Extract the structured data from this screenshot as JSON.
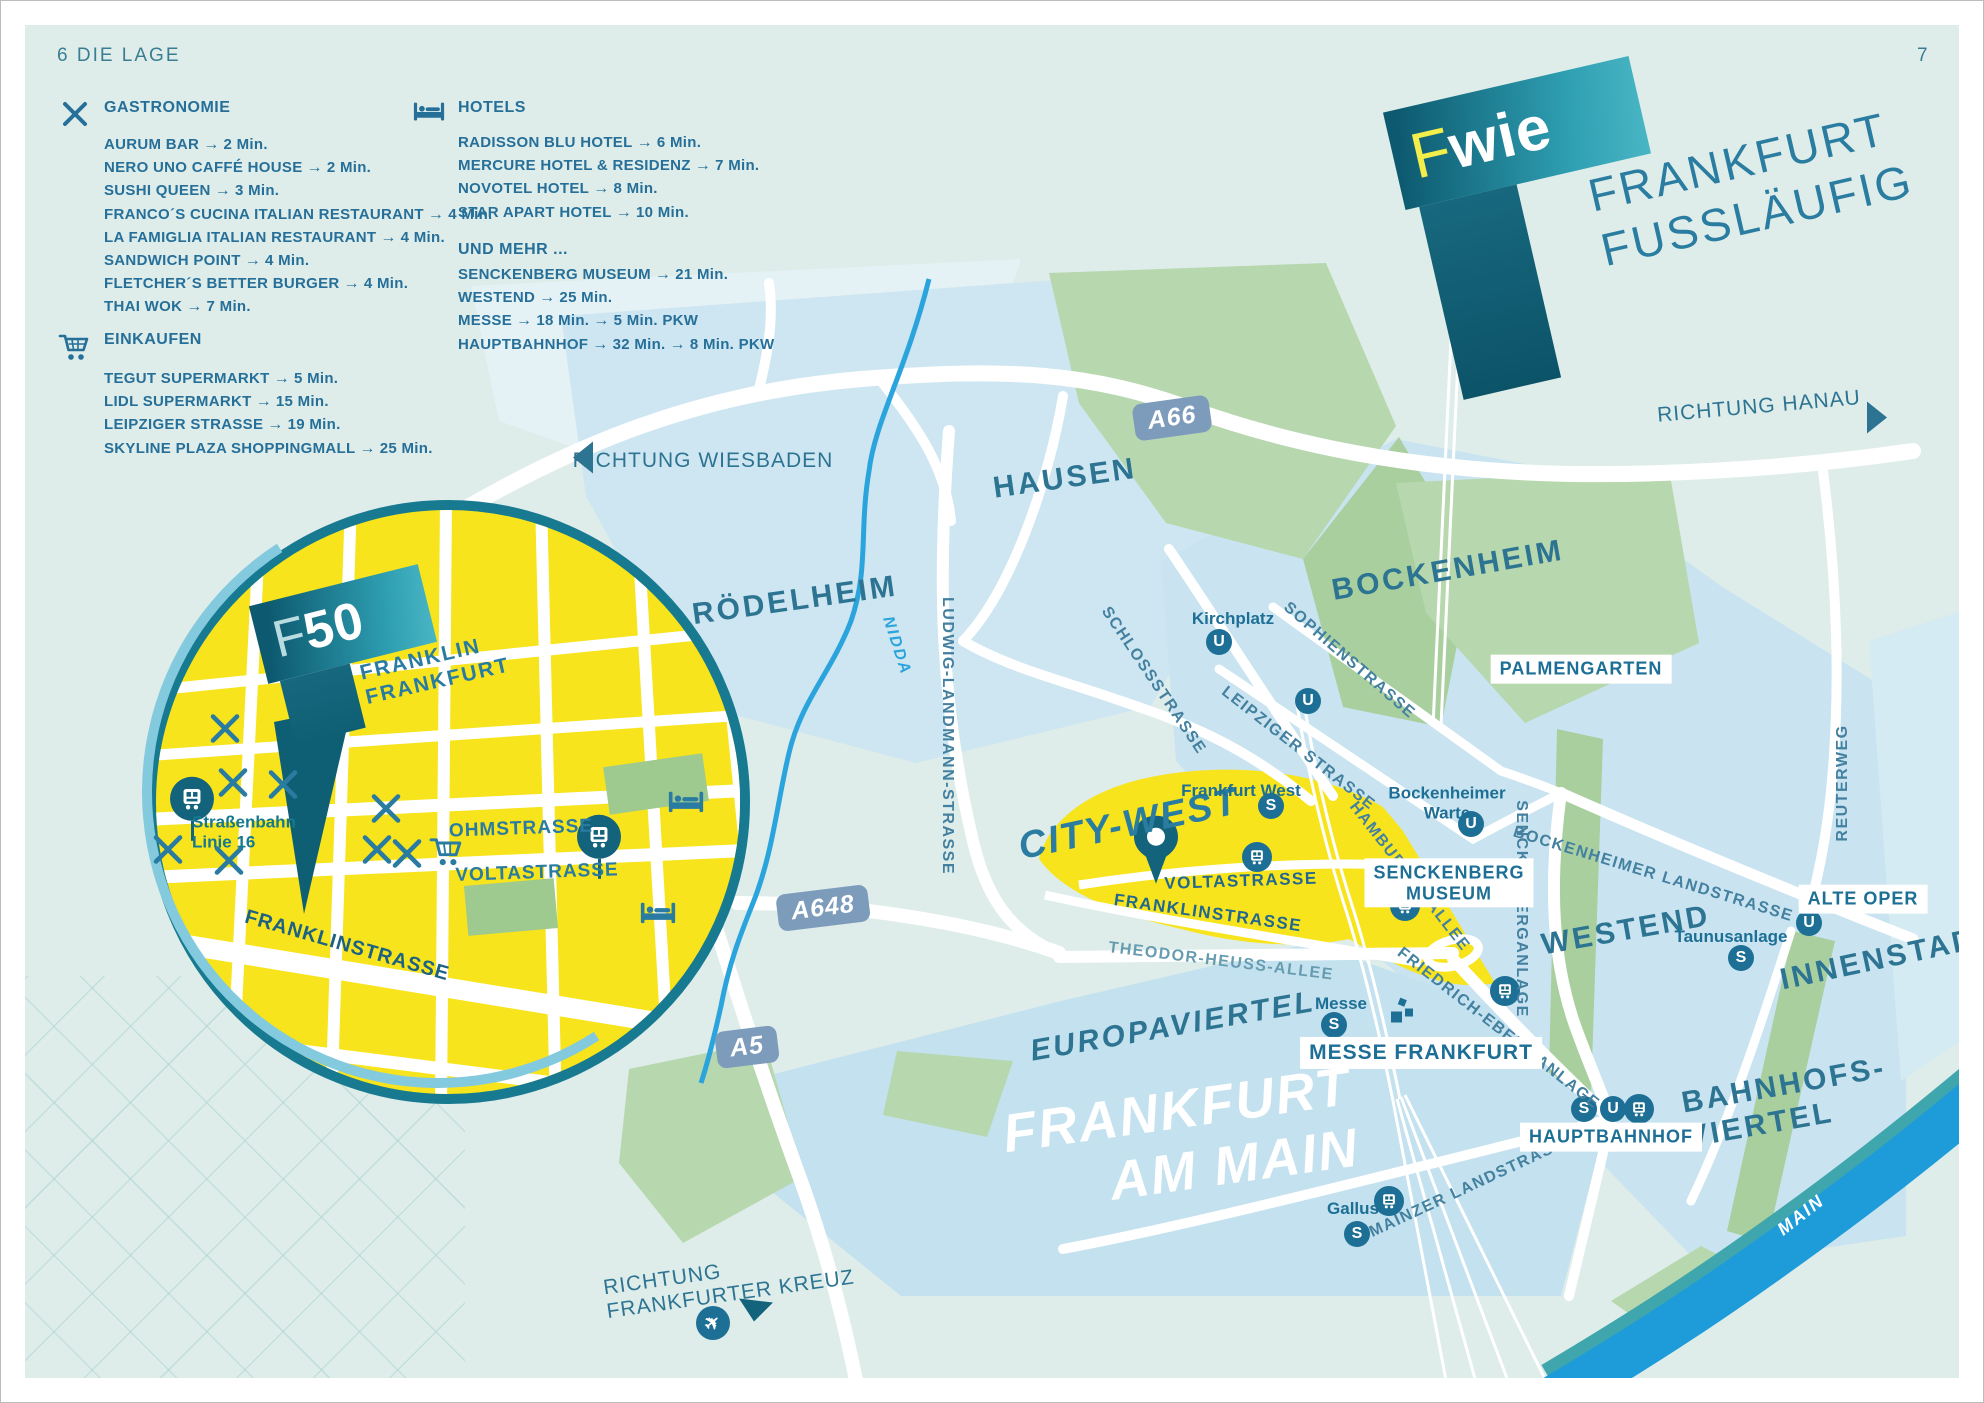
{
  "page": {
    "left_label": "6  DIE LAGE",
    "right_label": "7"
  },
  "colors": {
    "accent_teal": "#1d6f95",
    "district_teal": "#2d7492",
    "yellow": "#f7e41c",
    "light_blue": "#c9e4f0",
    "green": "#b7d7ae",
    "river_blue": "#1e9bd9",
    "badge_blue": "#7d9cbc",
    "logo_yellow": "#f3ee49",
    "rim_teal": "#177a90"
  },
  "legend": {
    "gastronomie": {
      "title": "GASTRONOMIE",
      "icon": "fork-knife-icon",
      "items": [
        {
          "label": "AURUM BAR",
          "times": [
            "2 Min."
          ]
        },
        {
          "label": "NERO UNO CAFFÉ HOUSE",
          "times": [
            "2 Min."
          ]
        },
        {
          "label": "SUSHI QUEEN",
          "times": [
            "3 Min."
          ]
        },
        {
          "label": "FRANCO´S CUCINA ITALIAN RESTAURANT",
          "times": [
            "4 Min."
          ]
        },
        {
          "label": "LA FAMIGLIA ITALIAN RESTAURANT",
          "times": [
            "4 Min."
          ]
        },
        {
          "label": "SANDWICH POINT",
          "times": [
            "4 Min."
          ]
        },
        {
          "label": "FLETCHER´S BETTER BURGER",
          "times": [
            "4 Min."
          ]
        },
        {
          "label": "THAI WOK",
          "times": [
            "7 Min."
          ]
        }
      ]
    },
    "einkaufen": {
      "title": "EINKAUFEN",
      "icon": "shopping-cart-icon",
      "items": [
        {
          "label": "TEGUT SUPERMARKT",
          "times": [
            "5 Min."
          ]
        },
        {
          "label": "LIDL SUPERMARKT",
          "times": [
            "15 Min."
          ]
        },
        {
          "label": "LEIPZIGER STRASSE",
          "times": [
            "19 Min."
          ]
        },
        {
          "label": "SKYLINE PLAZA SHOPPINGMALL",
          "times": [
            "25 Min."
          ]
        }
      ]
    },
    "hotels": {
      "title": "HOTELS",
      "icon": "hotel-bed-icon",
      "items": [
        {
          "label": "RADISSON BLU HOTEL",
          "times": [
            "6 Min."
          ]
        },
        {
          "label": "MERCURE HOTEL & RESIDENZ",
          "times": [
            "7 Min."
          ]
        },
        {
          "label": "NOVOTEL HOTEL",
          "times": [
            "8 Min."
          ]
        },
        {
          "label": "STAR APART HOTEL",
          "times": [
            "10 Min."
          ]
        }
      ]
    },
    "und_mehr": {
      "title": "UND MEHR ...",
      "items": [
        {
          "label": "SENCKENBERG MUSEUM",
          "times": [
            "21 Min."
          ]
        },
        {
          "label": "WESTEND",
          "times": [
            "25 Min."
          ]
        },
        {
          "label": "MESSE",
          "times": [
            "18 Min.",
            "5 Min. PKW"
          ]
        },
        {
          "label": "HAUPTBAHNHOF",
          "times": [
            "32 Min.",
            "8 Min. PKW"
          ]
        }
      ]
    },
    "arrow": "→"
  },
  "logo": {
    "f": "F",
    "wie": "wie",
    "line1": "FRANKFURT",
    "line2": "FUSSLÄUFIG"
  },
  "inset_logo": {
    "f": "F",
    "n50": "50"
  },
  "map": {
    "labels": [
      {
        "t": "RÖDELHEIM",
        "x": 794,
        "y": 600,
        "r": -8,
        "c": "district",
        "n": "district-roedelheim"
      },
      {
        "t": "HAUSEN",
        "x": 1064,
        "y": 478,
        "r": -8,
        "c": "district",
        "n": "district-hausen"
      },
      {
        "t": "BOCKENHEIM",
        "x": 1447,
        "y": 570,
        "r": -10,
        "c": "district",
        "n": "district-bockenheim"
      },
      {
        "t": "WESTEND",
        "x": 1625,
        "y": 930,
        "r": -10,
        "c": "district",
        "n": "district-westend"
      },
      {
        "t": "INNENSTADT",
        "x": 1888,
        "y": 957,
        "r": -12,
        "c": "district",
        "n": "district-innenstadt"
      },
      {
        "lines": [
          "BAHNHOFS-",
          "VIERTEL"
        ],
        "x": 1786,
        "y": 1102,
        "r": -10,
        "c": "district",
        "n": "district-bahnhofsviertel"
      },
      {
        "t": "EUROPAVIERTEL",
        "x": 1172,
        "y": 1026,
        "r": -10,
        "c": "district italic",
        "n": "district-europaviertel"
      },
      {
        "t": "CITY-WEST",
        "x": 1128,
        "y": 824,
        "r": -12,
        "c": "citywest",
        "n": "district-city-west"
      },
      {
        "lines": [
          "FRANKFURT",
          "AM MAIN"
        ],
        "x": 1180,
        "y": 1140,
        "r": -8,
        "c": "bigcity",
        "n": "label-frankfurt-am-main"
      },
      {
        "t": "SCHLOSSSTRASSE",
        "x": 1152,
        "y": 680,
        "r": 56,
        "c": "street",
        "n": "street-schlossstrasse"
      },
      {
        "t": "SOPHIENSTRASSE",
        "x": 1348,
        "y": 660,
        "r": 41,
        "c": "street",
        "n": "street-sophienstrasse"
      },
      {
        "t": "LEIPZIGER STRASSE",
        "x": 1297,
        "y": 748,
        "r": 38,
        "c": "street",
        "n": "street-leipziger-strasse"
      },
      {
        "t": "LUDWIG-LANDMANN-STRASSE",
        "x": 946,
        "y": 735,
        "r": 90,
        "c": "street",
        "n": "street-ludwig-landmann-strasse"
      },
      {
        "t": "HAMBURGER ALLEE",
        "x": 1408,
        "y": 876,
        "r": 52,
        "c": "street",
        "n": "street-hamburger-allee"
      },
      {
        "t": "SENCKENBERGANLAGE",
        "x": 1520,
        "y": 908,
        "r": 90,
        "c": "street",
        "n": "street-senckenberganlage"
      },
      {
        "t": "BOCKENHEIMER LANDSTRASSE",
        "x": 1652,
        "y": 874,
        "r": 17,
        "c": "street",
        "n": "street-bockenheimer-landstrasse"
      },
      {
        "t": "FRIEDRICH-EBERT-ANLAGE",
        "x": 1497,
        "y": 1028,
        "r": 38,
        "c": "street",
        "n": "street-friedrich-ebert-anlage"
      },
      {
        "t": "THEODOR-HEUSS-ALLEE",
        "x": 1220,
        "y": 961,
        "r": 7,
        "c": "street light",
        "n": "street-theodor-heuss-allee"
      },
      {
        "t": "MAINZER LANDSTRASSE",
        "x": 1472,
        "y": 1185,
        "r": -25,
        "c": "street",
        "n": "street-mainzer-landstrasse"
      },
      {
        "t": "REUTERWEG",
        "x": 1842,
        "y": 782,
        "r": -90,
        "c": "street",
        "n": "street-reuterweg"
      },
      {
        "t": "VOLTASTRASSE",
        "x": 1240,
        "y": 880,
        "r": -2,
        "c": "street strong",
        "n": "street-voltastrasse-citywest"
      },
      {
        "t": "FRANKLINSTRASSE",
        "x": 1207,
        "y": 912,
        "r": 8,
        "c": "street strong",
        "n": "street-franklinstrasse-citywest"
      },
      {
        "t": "NIDDA",
        "x": 895,
        "y": 645,
        "r": 72,
        "c": "river",
        "n": "river-nidda-label"
      },
      {
        "t": "MAIN",
        "x": 1800,
        "y": 1214,
        "r": -38,
        "c": "mainriver",
        "n": "river-main-label"
      },
      {
        "t": "Kirchplatz",
        "x": 1232,
        "y": 618,
        "r": 0,
        "c": "stn",
        "n": "station-kirchplatz"
      },
      {
        "lines": [
          "Bockenheimer",
          "Warte"
        ],
        "x": 1446,
        "y": 802,
        "r": 0,
        "c": "stn",
        "n": "station-bockenheimer-warte"
      },
      {
        "t": "Frankfurt West",
        "x": 1240,
        "y": 790,
        "r": 0,
        "c": "stn",
        "n": "station-frankfurt-west"
      },
      {
        "t": "Taunusanlage",
        "x": 1730,
        "y": 936,
        "r": 0,
        "c": "stn",
        "n": "station-taunusanlage"
      },
      {
        "t": "Messe",
        "x": 1340,
        "y": 1003,
        "r": 0,
        "c": "stn",
        "n": "station-messe"
      },
      {
        "t": "Gallus",
        "x": 1352,
        "y": 1208,
        "r": 0,
        "c": "stn",
        "n": "station-gallus"
      },
      {
        "t": "PALMENGARTEN",
        "x": 1580,
        "y": 668,
        "r": 0,
        "c": "boxlabel",
        "n": "poi-palmengarten"
      },
      {
        "lines": [
          "SENCKENBERG",
          "MUSEUM"
        ],
        "x": 1448,
        "y": 882,
        "r": 0,
        "c": "boxlabel",
        "n": "poi-senckenberg-museum"
      },
      {
        "t": "ALTE OPER",
        "x": 1862,
        "y": 898,
        "r": 0,
        "c": "boxlabel",
        "n": "poi-alte-oper"
      },
      {
        "t": "HAUPTBAHNHOF",
        "x": 1610,
        "y": 1136,
        "r": 0,
        "c": "boxlabel",
        "n": "poi-hauptbahnhof"
      },
      {
        "t": "MESSE FRANKFURT",
        "x": 1420,
        "y": 1052,
        "r": 0,
        "c": "boxlabel big",
        "n": "poi-messe-frankfurt"
      },
      {
        "t": "RICHTUNG WIESBADEN",
        "x": 702,
        "y": 460,
        "r": 0,
        "c": "direction",
        "n": "direction-wiesbaden"
      },
      {
        "t": "RICHTUNG HANAU",
        "x": 1758,
        "y": 406,
        "r": -5,
        "c": "direction",
        "n": "direction-hanau"
      },
      {
        "lines": [
          "RICHTUNG",
          "FRANKFURTER KREUZ"
        ],
        "x": 728,
        "y": 1282,
        "r": -8,
        "c": "direction left",
        "n": "direction-frankfurter-kreuz"
      },
      {
        "lines": [
          "Straßenbahn",
          "Linie 16"
        ],
        "x": 243,
        "y": 831,
        "r": 0,
        "c": "tramlabel",
        "n": "label-strassenbahn-linie-16"
      },
      {
        "t": "OHMSTRASSE",
        "x": 520,
        "y": 828,
        "r": -2,
        "c": "insetstreet",
        "n": "inset-street-ohmstrasse"
      },
      {
        "t": "VOLTASTRASSE",
        "x": 536,
        "y": 872,
        "r": -2,
        "c": "insetstreet",
        "n": "inset-street-voltastrasse"
      },
      {
        "t": "FRANKLINSTRASSE",
        "x": 346,
        "y": 945,
        "r": 16,
        "c": "insetstreet big",
        "n": "inset-street-franklinstrasse"
      },
      {
        "lines": [
          "FRANKLIN",
          "FRANKFURT"
        ],
        "x": 434,
        "y": 668,
        "r": -13,
        "c": "franklinlogo",
        "n": "inset-franklin-frankfurt-label"
      }
    ],
    "badges": [
      {
        "t": "A66",
        "x": 1171,
        "y": 417,
        "r": -8,
        "n": "highway-badge-a66"
      },
      {
        "t": "A648",
        "x": 822,
        "y": 907,
        "r": -7,
        "n": "highway-badge-a648"
      },
      {
        "t": "A5",
        "x": 746,
        "y": 1046,
        "r": -7,
        "n": "highway-badge-a5"
      }
    ],
    "icons": [
      {
        "type": "u",
        "x": 1218,
        "y": 641,
        "n": "ubahn-icon-kirchplatz"
      },
      {
        "type": "u",
        "x": 1307,
        "y": 700,
        "n": "ubahn-icon-leipziger-strasse"
      },
      {
        "type": "u",
        "x": 1470,
        "y": 823,
        "n": "ubahn-icon-bockenheimer-warte"
      },
      {
        "type": "u",
        "x": 1808,
        "y": 922,
        "n": "ubahn-icon-alte-oper"
      },
      {
        "type": "u",
        "x": 1612,
        "y": 1108,
        "n": "ubahn-icon-hauptbahnhof"
      },
      {
        "type": "s",
        "x": 1270,
        "y": 805,
        "n": "sbahn-icon-frankfurt-west"
      },
      {
        "type": "s",
        "x": 1740,
        "y": 957,
        "n": "sbahn-icon-taunusanlage"
      },
      {
        "type": "s",
        "x": 1333,
        "y": 1024,
        "n": "sbahn-icon-messe"
      },
      {
        "type": "s",
        "x": 1583,
        "y": 1108,
        "n": "sbahn-icon-hauptbahnhof"
      },
      {
        "type": "s",
        "x": 1356,
        "y": 1233,
        "n": "sbahn-icon-gallus"
      },
      {
        "type": "tram",
        "x": 1256,
        "y": 856,
        "n": "tram-icon-city-west"
      },
      {
        "type": "tram",
        "x": 1404,
        "y": 905,
        "n": "tram-icon-hamburger-allee"
      },
      {
        "type": "tram",
        "x": 1504,
        "y": 990,
        "n": "tram-icon-senckenberganlage"
      },
      {
        "type": "tram",
        "x": 1638,
        "y": 1108,
        "n": "tram-icon-hauptbahnhof"
      },
      {
        "type": "tram",
        "x": 1388,
        "y": 1200,
        "n": "tram-icon-gallus"
      },
      {
        "type": "tramstop",
        "x": 191,
        "y": 795,
        "n": "tram-stop-icon-linie16-west"
      },
      {
        "type": "tramstop",
        "x": 598,
        "y": 833,
        "n": "tram-stop-icon-ohmstrasse"
      },
      {
        "type": "fork",
        "x": 224,
        "y": 730,
        "n": "restaurant-icon"
      },
      {
        "type": "fork",
        "x": 232,
        "y": 784,
        "n": "restaurant-icon"
      },
      {
        "type": "fork",
        "x": 282,
        "y": 786,
        "n": "restaurant-icon"
      },
      {
        "type": "fork",
        "x": 385,
        "y": 810,
        "n": "restaurant-icon"
      },
      {
        "type": "fork",
        "x": 167,
        "y": 851,
        "n": "restaurant-icon"
      },
      {
        "type": "fork",
        "x": 228,
        "y": 862,
        "n": "restaurant-icon"
      },
      {
        "type": "fork",
        "x": 376,
        "y": 851,
        "n": "restaurant-icon"
      },
      {
        "type": "fork",
        "x": 406,
        "y": 855,
        "n": "restaurant-icon"
      },
      {
        "type": "cart",
        "x": 446,
        "y": 853,
        "n": "shopping-icon-inset"
      },
      {
        "type": "bed",
        "x": 685,
        "y": 805,
        "n": "hotel-icon-in-inset-ne"
      },
      {
        "type": "bed",
        "x": 657,
        "y": 916,
        "n": "hotel-icon-in-inset-se"
      },
      {
        "type": "plane",
        "x": 712,
        "y": 1322,
        "n": "airport-icon"
      },
      {
        "type": "trileft",
        "x": 582,
        "y": 459,
        "n": "arrow-west-icon"
      },
      {
        "type": "triright",
        "x": 1876,
        "y": 419,
        "n": "arrow-east-icon"
      },
      {
        "type": "tridown",
        "x": 755,
        "y": 1311,
        "n": "arrow-south-icon"
      },
      {
        "type": "messe",
        "x": 1402,
        "y": 1012,
        "n": "messe-tower-icon"
      },
      {
        "type": "pin",
        "x": 1155,
        "y": 882,
        "n": "location-pin-icon"
      }
    ]
  }
}
